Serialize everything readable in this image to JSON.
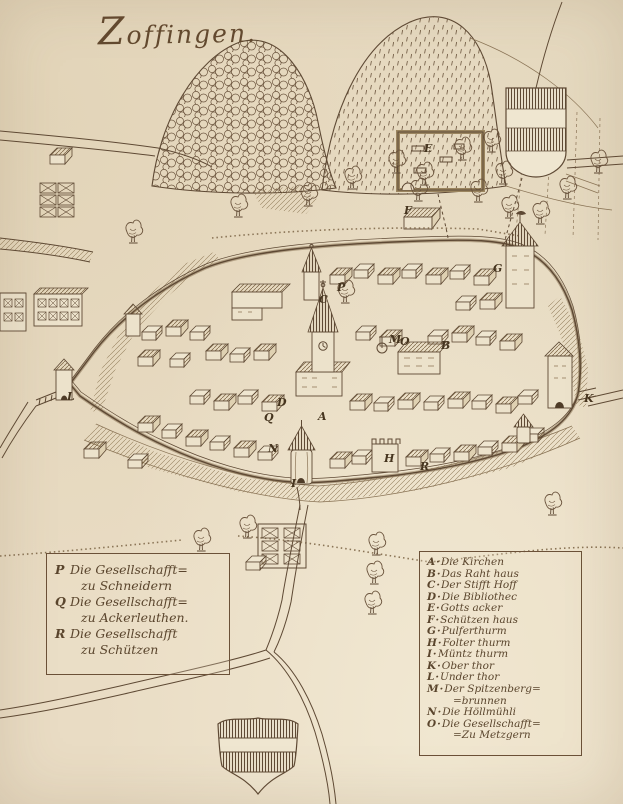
{
  "title": "Zoffingen.",
  "palette": {
    "paper": "#e9dcc4",
    "ink": "#5e4934",
    "ink_light": "#8a7456"
  },
  "legend_left": {
    "entries": [
      {
        "letter": "P",
        "line1": "Die Gesellschafft=",
        "line2": "zu Schneidern"
      },
      {
        "letter": "Q",
        "line1": "Die Gesellschafft=",
        "line2": "zu Ackerleuthen."
      },
      {
        "letter": "R",
        "line1": "Die Gesellschafft",
        "line2": "zu Schützen"
      }
    ]
  },
  "legend_right": {
    "entries": [
      {
        "letter": "A",
        "text": "Die Kirchen"
      },
      {
        "letter": "B",
        "text": "Das Raht haus"
      },
      {
        "letter": "C",
        "text": "Der Stifft Hoff"
      },
      {
        "letter": "D",
        "text": "Die Bibliothec"
      },
      {
        "letter": "E",
        "text": "Gotts acker"
      },
      {
        "letter": "F",
        "text": "Schützen haus"
      },
      {
        "letter": "G",
        "text": "Pulferthurm"
      },
      {
        "letter": "H",
        "text": "Folter thurm"
      },
      {
        "letter": "I",
        "text": "Müntz thurm"
      },
      {
        "letter": "K",
        "text": "Ober thor"
      },
      {
        "letter": "L",
        "text": "Under thor"
      },
      {
        "letter": "M",
        "text": "Der Spitzenberg=",
        "text2": "=brunnen"
      },
      {
        "letter": "N",
        "text": "Die Höllmühli"
      },
      {
        "letter": "O",
        "text": "Die Gesellschafft=",
        "text2": "=Zu Metzgern"
      }
    ]
  },
  "map_markers": [
    {
      "letter": "A",
      "x": 318,
      "y": 420
    },
    {
      "letter": "B",
      "x": 441,
      "y": 349
    },
    {
      "letter": "C",
      "x": 319,
      "y": 303
    },
    {
      "letter": "D",
      "x": 277,
      "y": 406
    },
    {
      "letter": "E",
      "x": 424,
      "y": 152
    },
    {
      "letter": "F",
      "x": 404,
      "y": 214
    },
    {
      "letter": "G",
      "x": 493,
      "y": 272
    },
    {
      "letter": "H",
      "x": 384,
      "y": 462
    },
    {
      "letter": "I",
      "x": 291,
      "y": 487
    },
    {
      "letter": "K",
      "x": 584,
      "y": 402
    },
    {
      "letter": "L",
      "x": 67,
      "y": 400
    },
    {
      "letter": "M",
      "x": 389,
      "y": 343
    },
    {
      "letter": "N",
      "x": 268,
      "y": 452
    },
    {
      "letter": "O",
      "x": 400,
      "y": 345
    },
    {
      "letter": "P",
      "x": 337,
      "y": 291
    },
    {
      "letter": "Q",
      "x": 264,
      "y": 421
    },
    {
      "letter": "R",
      "x": 420,
      "y": 470
    }
  ]
}
